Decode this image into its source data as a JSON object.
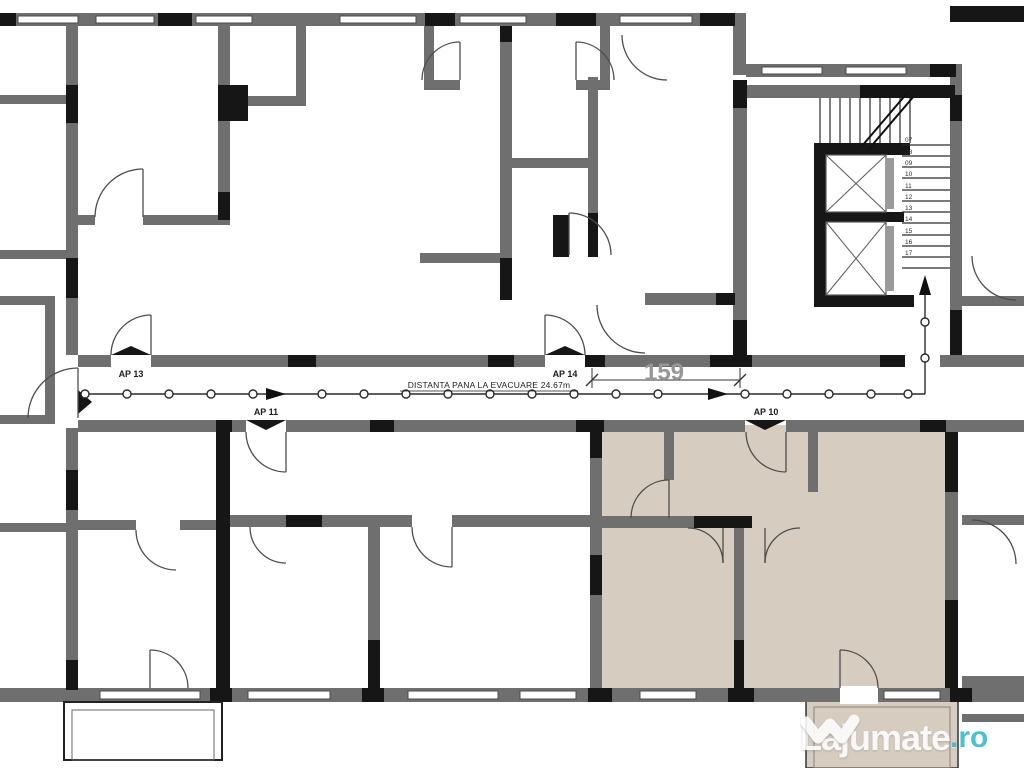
{
  "plan": {
    "apartment_labels": [
      {
        "id": "ap-13",
        "text": "AP 13"
      },
      {
        "id": "ap-11",
        "text": "AP 11"
      },
      {
        "id": "ap-14",
        "text": "AP 14"
      },
      {
        "id": "ap-10",
        "text": "AP 10"
      }
    ],
    "evacuation_route": {
      "label": "DISTANTA PANA LA EVACUARE 24.67m"
    },
    "dimension": {
      "value": "159"
    },
    "stairs": {
      "step_numbers": [
        "07",
        "08",
        "09",
        "10",
        "11",
        "12",
        "13",
        "14",
        "15",
        "16",
        "17"
      ]
    },
    "colors": {
      "wall": "#6f6f6f",
      "structure": "#161616",
      "highlight_apartment": "#d6cdc0",
      "background": "#ffffff",
      "route": "#2a2a2a"
    }
  },
  "watermark": {
    "site_name": "Lajumate",
    "tld": ".ro",
    "logo": "lajumate-logo",
    "text_color": "#ffffff",
    "tld_color": "#35b8cb"
  }
}
